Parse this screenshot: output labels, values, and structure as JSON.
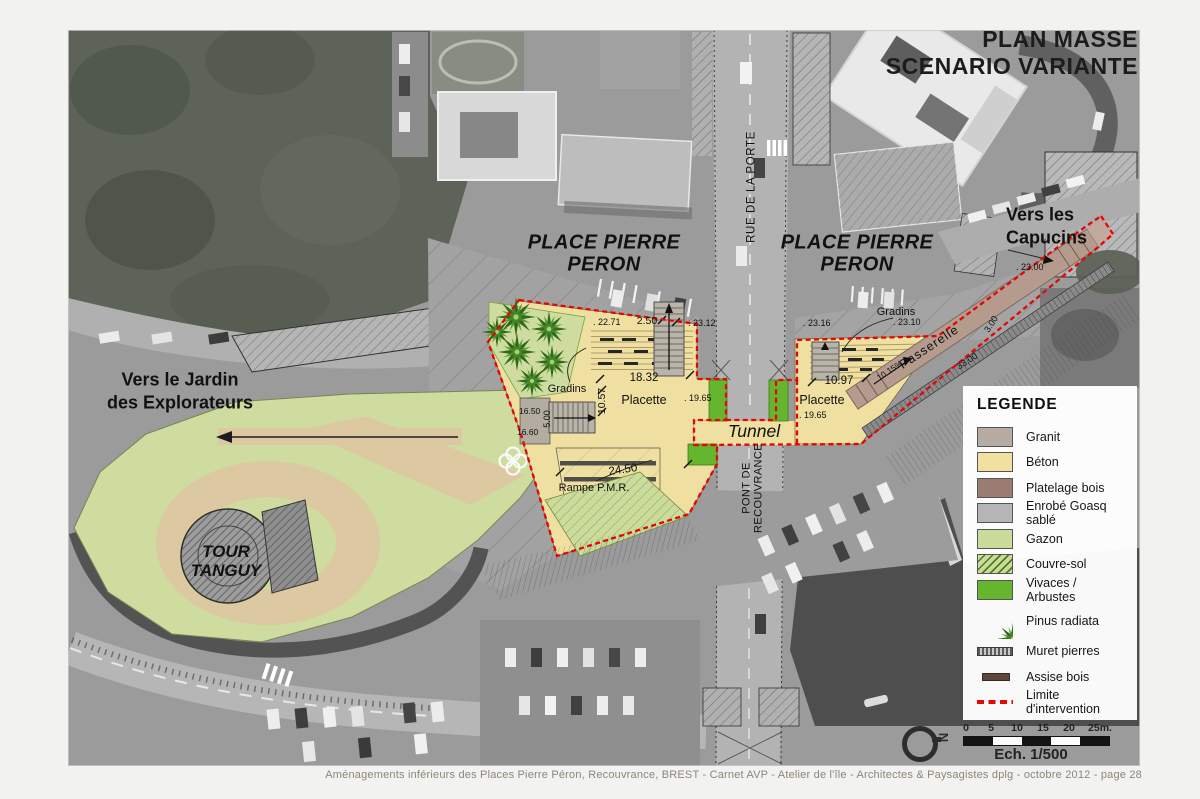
{
  "title": {
    "line1": "PLAN MASSE",
    "line2": "SCENARIO VARIANTE"
  },
  "footer": {
    "text": "Aménagements inférieurs des Places Pierre Péron, Recouvrance, BREST  -  Carnet AVP  -  Atelier de l'île  -  Architectes & Paysagistes dplg  -  octobre 2012 -  page 28"
  },
  "legend": {
    "title": "LEGENDE",
    "items": [
      {
        "label": "Granit",
        "color": "#b6aca3"
      },
      {
        "label": "Béton",
        "color": "#f1e0a0"
      },
      {
        "label": "Platelage bois",
        "color": "#9a7d70"
      },
      {
        "label": "Enrobé Goasq sablé",
        "color": "#b5b5b5"
      },
      {
        "label": "Gazon",
        "color": "#cbdc9a"
      },
      {
        "label": "Couvre-sol",
        "color": "#cbdc9a"
      },
      {
        "label": "Vivaces / Arbustes",
        "color": "#66b52e"
      },
      {
        "label": "Pinus radiata",
        "color": "#2e6b1e"
      },
      {
        "label": "Muret pierres",
        "color": "#5c5c5c"
      },
      {
        "label": "Assise bois",
        "color": "#5d473c"
      },
      {
        "label": "Limite d'intervention",
        "color": "#e60404"
      }
    ]
  },
  "scale": {
    "ticks": [
      "0",
      "5",
      "10",
      "15",
      "20",
      "25m."
    ],
    "caption": "Ech. 1/500"
  },
  "map": {
    "north": "N",
    "labels": {
      "place_peron_left": "PLACE PIERRE\nPERON",
      "place_peron_right": "PLACE PIERRE\nPERON",
      "vers_capucins": "Vers les\nCapucins",
      "vers_jardin": "Vers le Jardin\ndes Explorateurs",
      "tour_tanguy": "TOUR\nTANGUY",
      "tunnel": "Tunnel",
      "rue_de_la_porte": "RUE DE LA PORTE",
      "pont_de_recouvrance": "PONT DE\nRECOUVRANCE",
      "gradins_left": "Gradins",
      "gradins_right": "Gradins",
      "placette_left": "Placette",
      "placette_right": "Placette",
      "rampe_pmr": "Rampe P.M.R.",
      "passerelle": "Passerelle",
      "pente": "10.15%"
    },
    "dims": [
      ". 22.71",
      "2.50",
      ". 23.12",
      ". 23.16",
      ". 23.10",
      "18.32",
      "10.57",
      "16.50",
      "16.60",
      "5.00",
      "24.50",
      ". 19.65",
      ". 19.65",
      "10.97",
      ". 23.00",
      "3.00",
      "33.00"
    ]
  }
}
